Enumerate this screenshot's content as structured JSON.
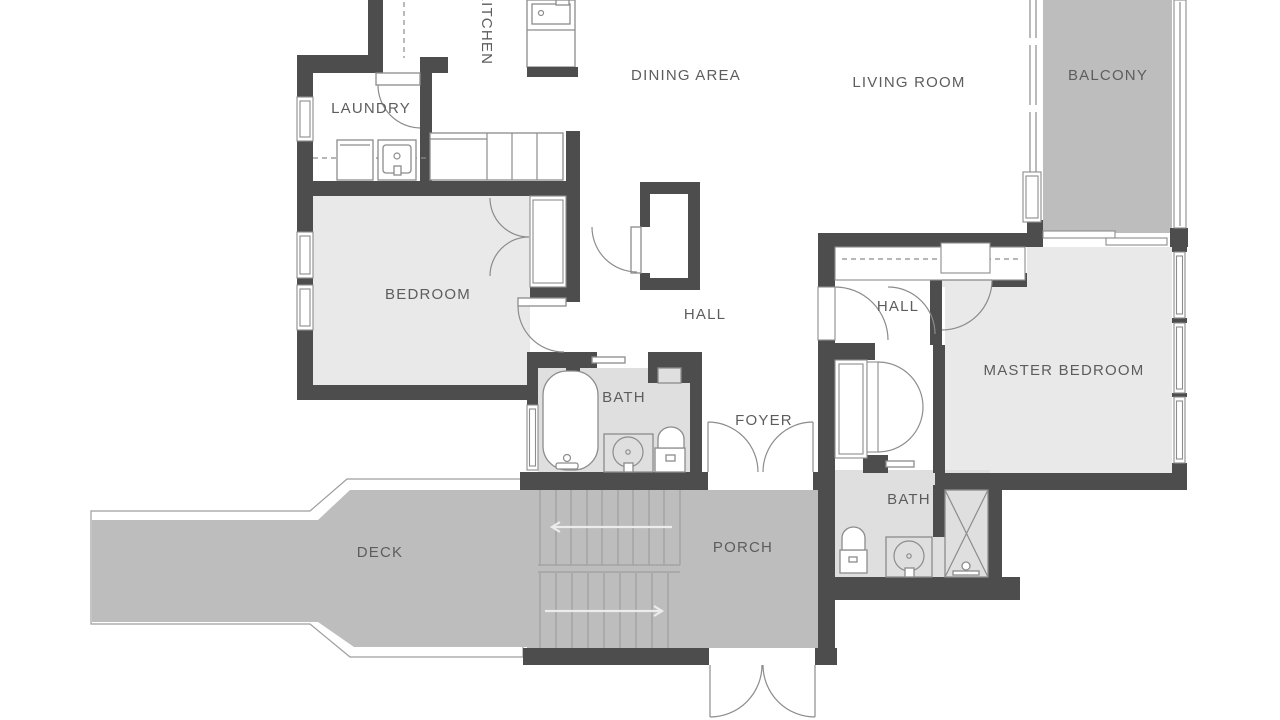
{
  "title": "Apartment floor plan",
  "colors": {
    "wall": "#4d4d4d",
    "room": "#e9e9e9",
    "bathfloor": "#dfdfdf",
    "outdoor": "#bdbdbd",
    "line": "#8c8c8c",
    "tread": "#9e9e9e",
    "arrow": "#ececec",
    "label": "#5d5d5d"
  },
  "rooms": {
    "kitchen": {
      "label": "KITCHEN"
    },
    "laundry": {
      "label": "LAUNDRY"
    },
    "dining": {
      "label": "DINING AREA"
    },
    "living": {
      "label": "LIVING ROOM"
    },
    "balcony": {
      "label": "BALCONY"
    },
    "bedroom": {
      "label": "BEDROOM"
    },
    "hall_center": {
      "label": "HALL"
    },
    "hall_right": {
      "label": "HALL"
    },
    "master": {
      "label": "MASTER BEDROOM"
    },
    "bath_center": {
      "label": "BATH"
    },
    "foyer": {
      "label": "FOYER"
    },
    "bath_right": {
      "label": "BATH"
    },
    "deck": {
      "label": "DECK"
    },
    "porch": {
      "label": "PORCH"
    }
  },
  "fixtures": [
    "bathtub",
    "vanity-sink",
    "toilet",
    "shower",
    "kitchen-island-sink",
    "washer",
    "laundry-sink",
    "closet-rod",
    "bifold-door",
    "pocket-door",
    "sliding-door",
    "door-swing",
    "window",
    "stairs-up-arrow",
    "stairs-down-arrow"
  ]
}
